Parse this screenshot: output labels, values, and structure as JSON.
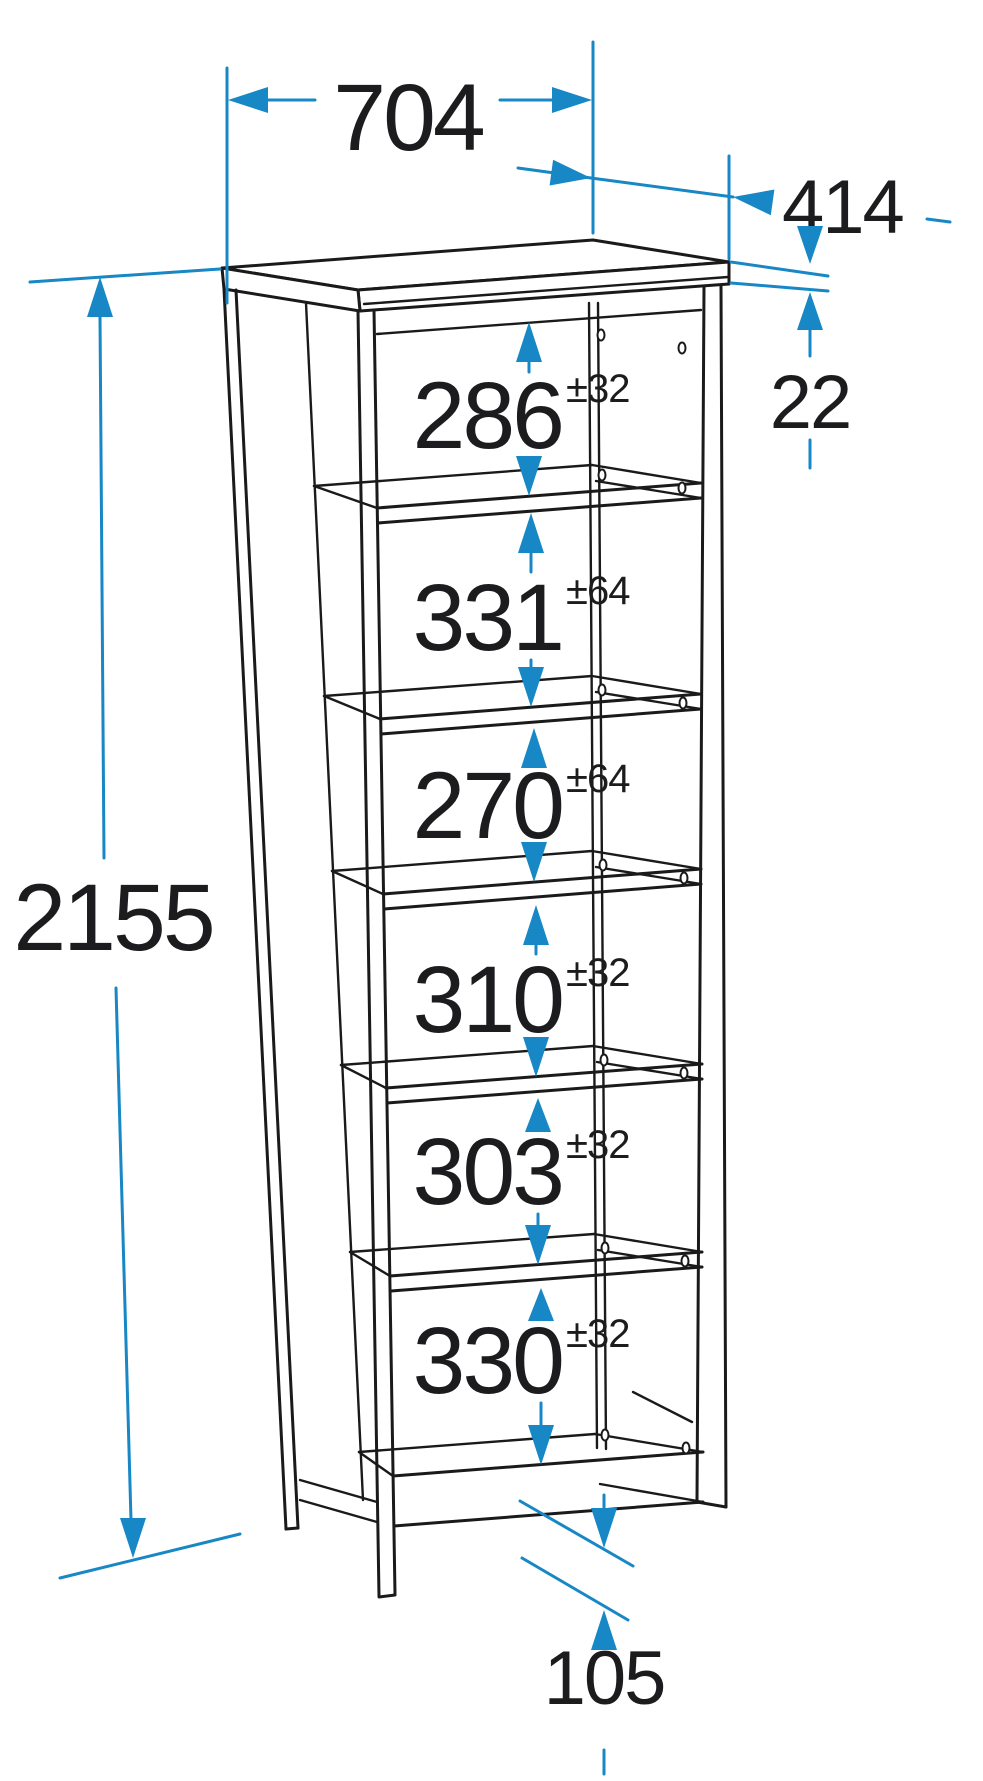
{
  "diagram": {
    "kind": "furniture-dimension-drawing",
    "colors": {
      "dimension_blue": "#1787C5",
      "linework_black": "#1A1A1A",
      "background": "#FFFFFF"
    }
  },
  "dimensions": {
    "width": "704",
    "depth": "414",
    "height": "2155",
    "top_thickness": "22",
    "plinth_height": "105"
  },
  "shelf_spacings": [
    {
      "value": "286",
      "tolerance": "±32"
    },
    {
      "value": "331",
      "tolerance": "±64"
    },
    {
      "value": "270",
      "tolerance": "±64"
    },
    {
      "value": "310",
      "tolerance": "±32"
    },
    {
      "value": "303",
      "tolerance": "±32"
    },
    {
      "value": "330",
      "tolerance": "±32"
    }
  ]
}
